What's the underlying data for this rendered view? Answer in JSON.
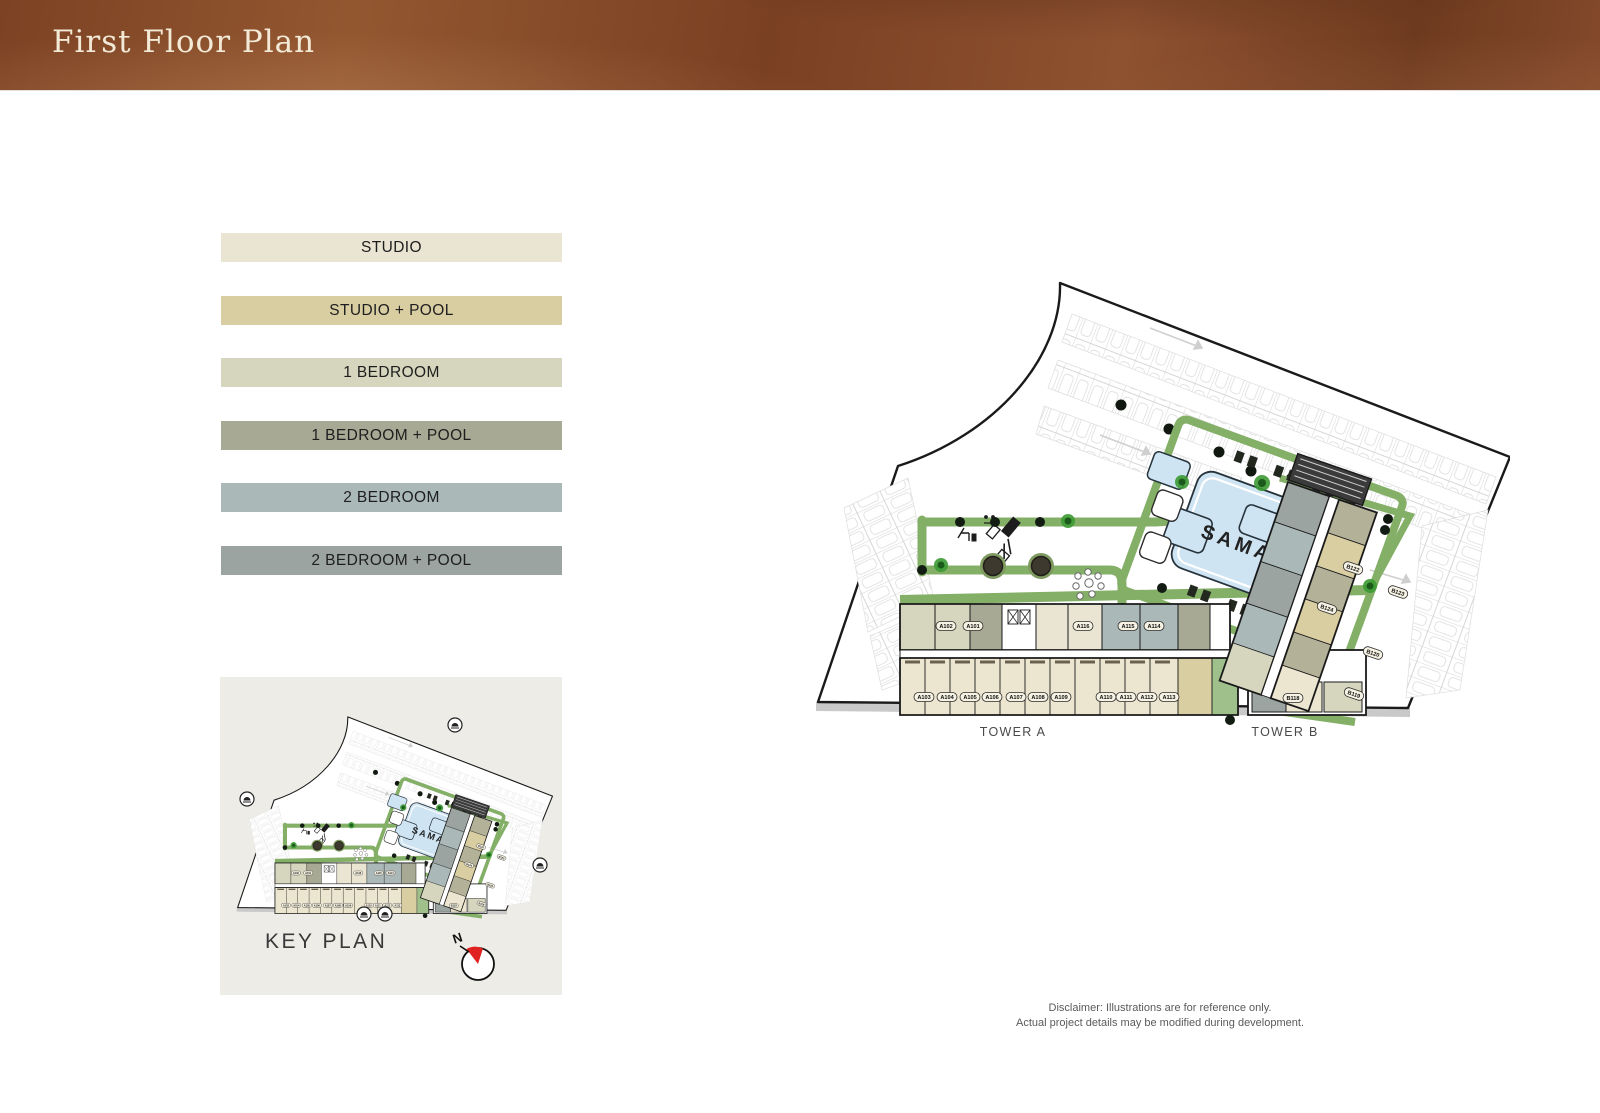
{
  "header": {
    "title": "First Floor Plan",
    "accent_color": "#81472a"
  },
  "legend": {
    "items": [
      {
        "label": "STUDIO",
        "color": "#e9e5d2"
      },
      {
        "label": "STUDIO + POOL",
        "color": "#d9cda2"
      },
      {
        "label": "1 BEDROOM",
        "color": "#d5d6bd"
      },
      {
        "label": "1 BEDROOM + POOL",
        "color": "#a8a994"
      },
      {
        "label": "2 BEDROOM",
        "color": "#abb8b8"
      },
      {
        "label": "2 BEDROOM + POOL",
        "color": "#9ba4a1"
      }
    ]
  },
  "key_plan": {
    "title": "KEY PLAN",
    "compass_letter": "N",
    "compass_color": "#e02320"
  },
  "plan": {
    "pool_label": "SAMANA",
    "tower_a_label": "TOWER A",
    "tower_b_label": "TOWER B",
    "tower_a_upper": [
      "A102",
      "A101",
      "A116",
      "A115",
      "A114"
    ],
    "tower_a_lower": [
      "A103",
      "A104",
      "A105",
      "A106",
      "A107",
      "A108",
      "A109",
      "A110",
      "A111",
      "A112",
      "A113"
    ],
    "tower_b_units": [
      "B122",
      "B123",
      "B124",
      "B120",
      "B119",
      "B118"
    ]
  },
  "disclaimer": {
    "line1": "Disclaimer: Illustrations are for reference only.",
    "line2": "Actual project details may be modified during development."
  }
}
